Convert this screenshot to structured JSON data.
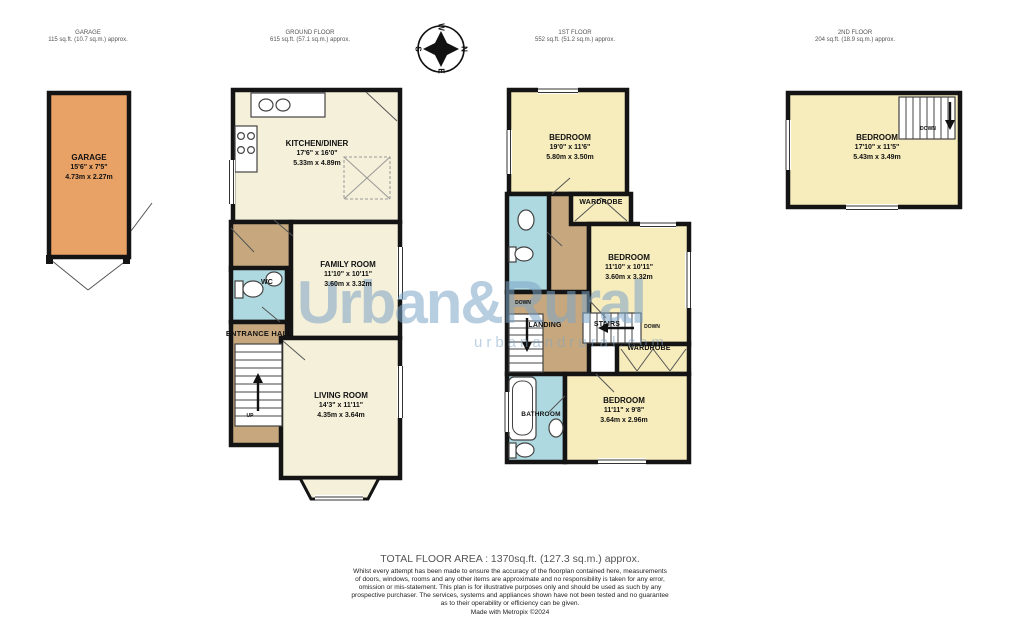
{
  "headers": {
    "garage": {
      "title": "GARAGE",
      "area": "115 sq.ft. (10.7 sq.m.) approx."
    },
    "ground": {
      "title": "GROUND FLOOR",
      "area": "615 sq.ft. (57.1 sq.m.) approx."
    },
    "first": {
      "title": "1ST FLOOR",
      "area": "552 sq.ft. (51.2 sq.m.) approx."
    },
    "second": {
      "title": "2ND FLOOR",
      "area": "204 sq.ft. (18.9 sq.m.) approx."
    }
  },
  "rooms": {
    "garage": {
      "name": "GARAGE",
      "ft": "15'6\" x 7'5\"",
      "m": "4.73m x 2.27m"
    },
    "kitchen": {
      "name": "KITCHEN/DINER",
      "ft": "17'6\" x 16'0\"",
      "m": "5.33m x 4.89m"
    },
    "family": {
      "name": "FAMILY ROOM",
      "ft": "11'10\" x 10'11\"",
      "m": "3.60m x 3.32m"
    },
    "living": {
      "name": "LIVING ROOM",
      "ft": "14'3\" x 11'11\"",
      "m": "4.35m x 3.64m"
    },
    "bedroom1": {
      "name": "BEDROOM",
      "ft": "19'0\" x 11'6\"",
      "m": "5.80m x 3.50m"
    },
    "bedroom2": {
      "name": "BEDROOM",
      "ft": "11'10\" x 10'11\"",
      "m": "3.60m x 3.32m"
    },
    "bedroom3": {
      "name": "BEDROOM",
      "ft": "11'11\" x 9'8\"",
      "m": "3.64m x 2.96m"
    },
    "bedroom4": {
      "name": "BEDROOM",
      "ft": "17'10\" x 11'5\"",
      "m": "5.43m x 3.49m"
    }
  },
  "labels": {
    "wc": "WC",
    "entrance_hall": "ENTRANCE HALL",
    "up": "UP",
    "down": "DOWN",
    "wardrobe": "WARDROBE",
    "landing": "LANDING",
    "stairs": "STAIRS",
    "bathroom": "BATHROOM"
  },
  "compass": {
    "n": "N",
    "e": "E",
    "s": "S",
    "w": "W"
  },
  "watermark": {
    "brand": "Urban&Rural",
    "site": "urbanandrural.com"
  },
  "footer": {
    "total": "TOTAL FLOOR AREA : 1370sq.ft. (127.3 sq.m.) approx.",
    "disclaimer_lines": [
      "Whilst every attempt has been made to ensure the accuracy of the floorplan contained here, measurements",
      "of doors, windows, rooms and any other items are approximate and no responsibility is taken for any error,",
      "omission or mis-statement. This plan is for illustrative purposes only and should be used as such by any",
      "prospective purchaser. The services, systems and appliances shown have not been tested and no guarantee",
      "as to their operability or efficiency can be given."
    ],
    "credit": "Made with Metropix ©2024"
  },
  "colors": {
    "garage_orange": "#e9a266",
    "room_cream": "#f5f0da",
    "bedroom_yellow": "#f7ecbc",
    "hall_tan": "#c7a87e",
    "wet_blue": "#aed9e0",
    "wall": "#141414",
    "watermark_blue": "#7ba4c6"
  }
}
